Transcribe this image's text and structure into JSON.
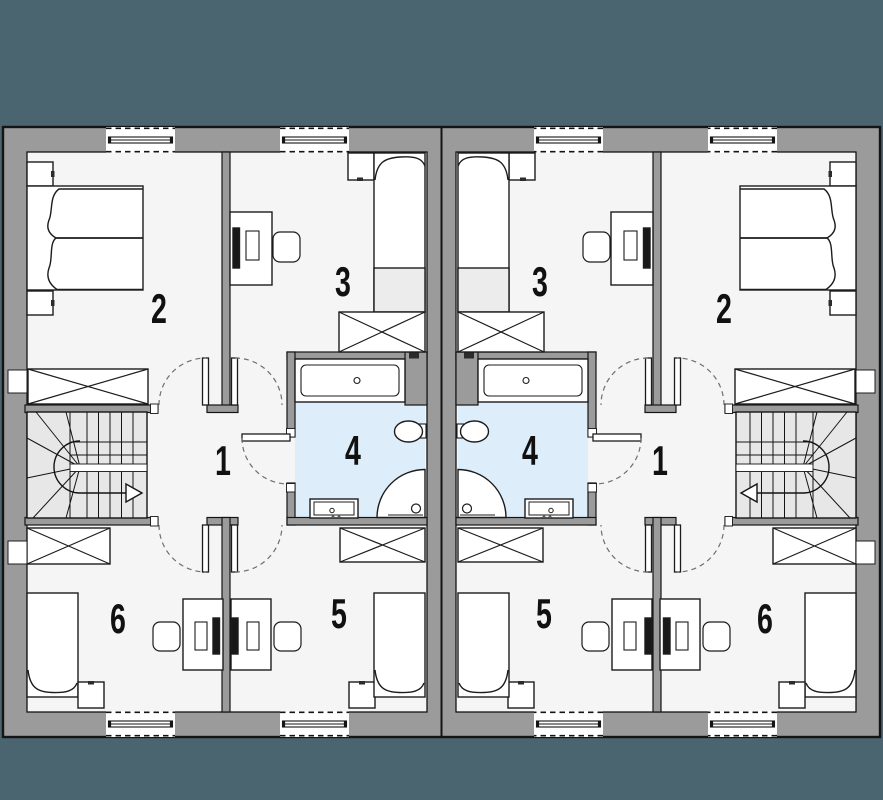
{
  "plan": {
    "title": "duplex-upper-floor-plan",
    "colors": {
      "background": "#4a656f",
      "wall": "#9b9b9b",
      "floor": "#f5f5f5",
      "bathroom_floor": "#ddedf9",
      "stairs": "#e7e7e7",
      "outline": "#141414"
    },
    "units": [
      {
        "side": "left",
        "rooms": [
          {
            "number": "1",
            "name": "hall-landing",
            "furniture": [
              "staircase",
              "doors"
            ]
          },
          {
            "number": "2",
            "name": "bedroom-double",
            "furniture": [
              "double-bed",
              "nightstand",
              "nightstand",
              "wardrobe"
            ]
          },
          {
            "number": "3",
            "name": "bedroom",
            "furniture": [
              "single-bed",
              "nightstand",
              "desk",
              "chair",
              "monitor",
              "wardrobe"
            ]
          },
          {
            "number": "4",
            "name": "bathroom",
            "furniture": [
              "bathtub",
              "toilet",
              "shower",
              "washbasin"
            ]
          },
          {
            "number": "5",
            "name": "bedroom",
            "furniture": [
              "single-bed",
              "nightstand",
              "desk",
              "chair",
              "monitor",
              "wardrobe"
            ]
          },
          {
            "number": "6",
            "name": "bedroom",
            "furniture": [
              "single-bed",
              "nightstand",
              "desk",
              "chair",
              "monitor",
              "wardrobe"
            ]
          }
        ]
      },
      {
        "side": "right",
        "rooms": [
          {
            "number": "1",
            "name": "hall-landing",
            "furniture": [
              "staircase",
              "doors"
            ]
          },
          {
            "number": "2",
            "name": "bedroom-double",
            "furniture": [
              "double-bed",
              "nightstand",
              "nightstand",
              "wardrobe"
            ]
          },
          {
            "number": "3",
            "name": "bedroom",
            "furniture": [
              "single-bed",
              "nightstand",
              "desk",
              "chair",
              "monitor",
              "wardrobe"
            ]
          },
          {
            "number": "4",
            "name": "bathroom",
            "furniture": [
              "bathtub",
              "toilet",
              "shower",
              "washbasin"
            ]
          },
          {
            "number": "5",
            "name": "bedroom",
            "furniture": [
              "single-bed",
              "nightstand",
              "desk",
              "chair",
              "monitor",
              "wardrobe"
            ]
          },
          {
            "number": "6",
            "name": "bedroom",
            "furniture": [
              "single-bed",
              "nightstand",
              "desk",
              "chair",
              "monitor",
              "wardrobe"
            ]
          }
        ]
      }
    ]
  }
}
